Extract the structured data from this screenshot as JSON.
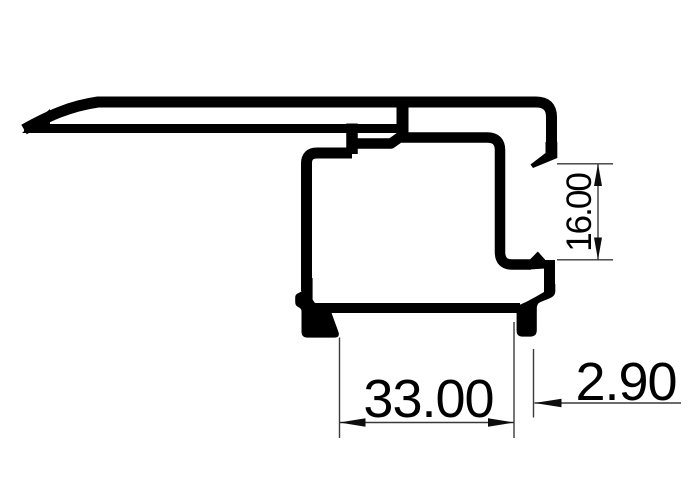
{
  "document": {
    "type": "technical_drawing",
    "subject": "aluminium extrusion profile cross-section",
    "background_color": "#ffffff",
    "profile_color": "#000000",
    "dimension_line_color": "#3a3a3a",
    "text_color": "#000000"
  },
  "dimensions": {
    "groove_height": {
      "value": "16.00",
      "orientation": "vertical",
      "location": "right side channel opening"
    },
    "base_width": {
      "value": "33.00",
      "orientation": "horizontal",
      "location": "bottom between feet"
    },
    "lip_width": {
      "value": "2.90",
      "orientation": "horizontal",
      "location": "bottom right foot"
    }
  }
}
